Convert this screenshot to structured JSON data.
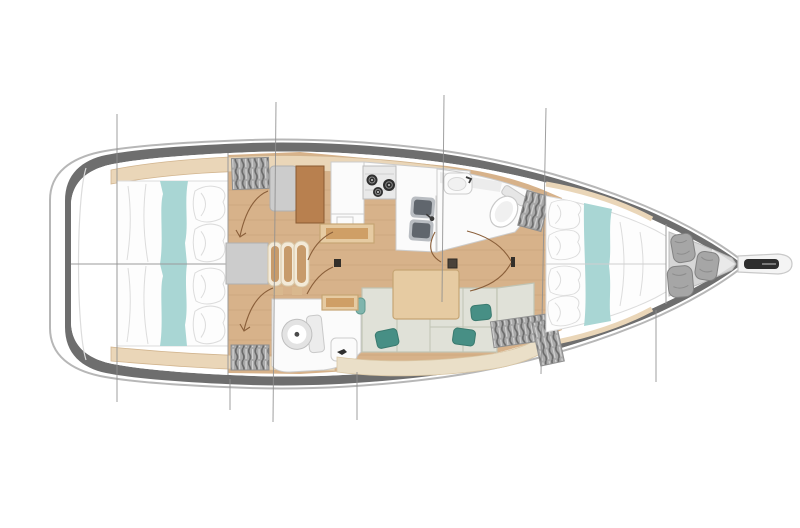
{
  "meta": {
    "title": "Sailboat interior layout floorplan",
    "view": "top-down deck plan",
    "orientation": "bow-right-stern-left",
    "visible_text": []
  },
  "parts": [
    "hull",
    "side-decks",
    "transom",
    "aft-cabin-port",
    "aft-cabin-starboard",
    "nav-station",
    "hanging-lockers",
    "galley",
    "stove",
    "double-sink",
    "forward-head",
    "aft-head",
    "saloon-sofa",
    "saloon-table",
    "forward-cabin-v-berth",
    "anchor-locker",
    "fender-bags",
    "bowsprit",
    "anchor-roller",
    "mast-step",
    "door-swing-arcs",
    "rig-lines"
  ],
  "counts": {
    "cabins": 3,
    "heads": 2,
    "stove_burners": 3,
    "fender_bags": 3,
    "nav_bench_arcs": 3,
    "rig_lines": 7
  },
  "colors": {
    "bg": "#ffffff",
    "hull_outline": "#b7b7b7",
    "hull_fill": "#ffffff",
    "deck_band": "#6e6e6e",
    "interior": "#ffffff",
    "floor_wood": "#d7b28a",
    "floor_grain": "#c39b72",
    "shelf_tan": "#ead6b8",
    "shelf_edge": "#d2b58f",
    "shelf_tick": "#b59a72",
    "linen": "#fdfdfd",
    "linen_edge": "#dcdcdc",
    "teal_runner": "#a9d6d4",
    "accent_teal": "#478f85",
    "accent_teal_edge": "#3a7a6f",
    "sofa_cushion": "#e0e1d8",
    "sofa_seam": "#c0c4b4",
    "sofa_base": "#eadfc8",
    "sofa_base_edge": "#d9c6a4",
    "table_wood": "#e6cba2",
    "table_edge": "#c6a574",
    "table_inner": "#cf9f66",
    "desk_brown": "#b8804f",
    "desk_edge": "#8a5a32",
    "cabinet_gray": "#cccccc",
    "locker_gray": "#a9a9a9",
    "locker_edge": "#8f8f8f",
    "locker_hatch": "#6b6b6b",
    "locker_hatch_light": "#d2d2d2",
    "bow_locker": "#d6d6d6",
    "bow_locker_tip": "#e9e9e9",
    "fixture_white": "#fbfbfb",
    "fixture_stroke": "#cccccc",
    "counter_gray": "#ececec",
    "sink_rim": "#b9bdc2",
    "sink_gray": "#60666d",
    "burner_dark": "#2f2f2f",
    "burner_ring": "#8c8c8c",
    "bag_gray": "#a6a6a6",
    "bag_edge": "#828282",
    "bag_fold": "#8d8d8d",
    "arc_brown": "#8a5f3a",
    "rig_line": "#8f8f8f",
    "bulkhead": "#9b9b9b",
    "slot_dark": "#2e2e2e",
    "jamb_dark": "#332f2a"
  }
}
